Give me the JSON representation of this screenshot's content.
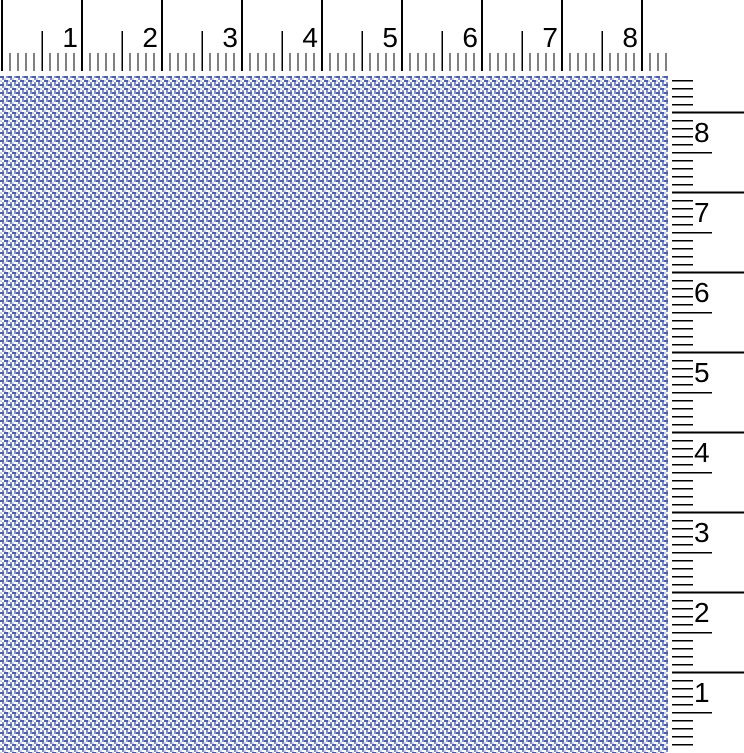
{
  "rulers": {
    "tick_color": "#000000",
    "horizontal": {
      "unit_labels": [
        "1",
        "2",
        "3",
        "4",
        "5",
        "6",
        "7",
        "8"
      ],
      "units_per_label": 1,
      "subdivisions_per_unit": 10
    },
    "vertical": {
      "unit_labels": [
        "8",
        "7",
        "6",
        "5",
        "4",
        "3",
        "2",
        "1"
      ],
      "units_per_label": 1,
      "subdivisions_per_unit": 10
    }
  },
  "fabric": {
    "palette": {
      "dark": "#4b5fa6",
      "medium": "#8292c9",
      "light": "#c9d1ea",
      "white": "#ffffff"
    },
    "tile_size_px": 8,
    "tile_cells": [
      [
        0,
        0,
        4,
        2,
        "dark"
      ],
      [
        4,
        0,
        2,
        2,
        "white"
      ],
      [
        6,
        0,
        2,
        2,
        "medium"
      ],
      [
        0,
        2,
        2,
        2,
        "white"
      ],
      [
        2,
        2,
        2,
        2,
        "medium"
      ],
      [
        4,
        2,
        2,
        2,
        "light"
      ],
      [
        6,
        2,
        2,
        2,
        "white"
      ],
      [
        0,
        4,
        2,
        2,
        "light"
      ],
      [
        2,
        4,
        2,
        2,
        "white"
      ],
      [
        4,
        4,
        4,
        2,
        "dark"
      ],
      [
        0,
        6,
        2,
        2,
        "white"
      ],
      [
        2,
        6,
        2,
        2,
        "medium"
      ],
      [
        4,
        6,
        2,
        2,
        "white"
      ],
      [
        6,
        6,
        2,
        2,
        "medium"
      ]
    ]
  }
}
